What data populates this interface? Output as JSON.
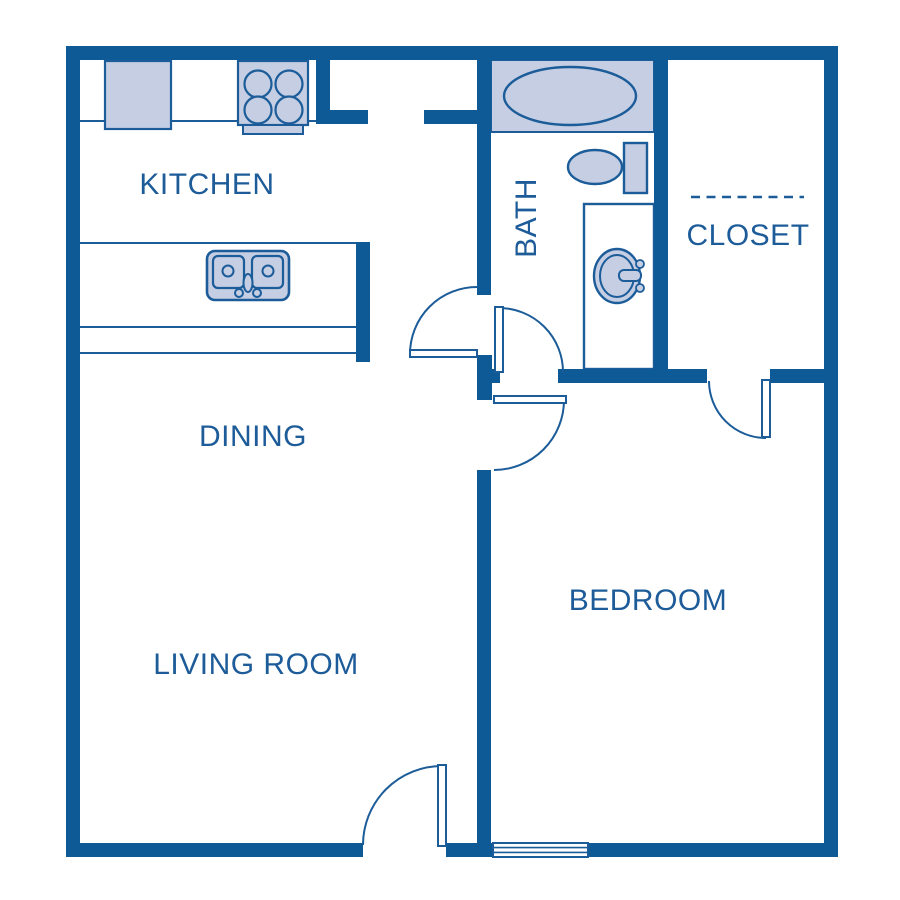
{
  "colors": {
    "wall": "#0E5A97",
    "line": "#1B5C99",
    "fill": "#C5CEE3",
    "white": "#FFFFFF",
    "text": "#1D5C99"
  },
  "rooms": [
    {
      "id": "kitchen",
      "label": "KITCHEN",
      "x": 207,
      "y": 185,
      "rotate": 0
    },
    {
      "id": "dining",
      "label": "DINING",
      "x": 253,
      "y": 437,
      "rotate": 0
    },
    {
      "id": "living-room",
      "label": "LIVING ROOM",
      "x": 256,
      "y": 665,
      "rotate": 0
    },
    {
      "id": "bedroom",
      "label": "BEDROOM",
      "x": 648,
      "y": 601,
      "rotate": 0
    },
    {
      "id": "bath",
      "label": "BATH",
      "x": 527,
      "y": 218,
      "rotate": -90
    },
    {
      "id": "closet",
      "label": "CLOSET",
      "x": 748,
      "y": 236,
      "rotate": 0
    }
  ],
  "plan": {
    "width": 900,
    "height": 900,
    "layers": [
      {
        "name": "counters",
        "items": [
          {
            "t": "line",
            "n": "kitchen-counter-edge",
            "x1": 80,
            "y1": 121,
            "x2": 316,
            "y2": 121,
            "s": "line",
            "sw": 2
          },
          {
            "t": "line",
            "n": "island-counter-edge-top",
            "x1": 80,
            "y1": 243,
            "x2": 356,
            "y2": 243,
            "s": "line",
            "sw": 2
          },
          {
            "t": "line",
            "n": "island-counter-edge-mid",
            "x1": 80,
            "y1": 327,
            "x2": 356,
            "y2": 327,
            "s": "line",
            "sw": 2
          },
          {
            "t": "line",
            "n": "island-counter-edge-bottom",
            "x1": 80,
            "y1": 353,
            "x2": 356,
            "y2": 353,
            "s": "line",
            "sw": 2
          }
        ]
      },
      {
        "name": "fixtures",
        "items": [
          {
            "t": "rect",
            "n": "refrigerator",
            "x": 105,
            "y": 61,
            "w": 66,
            "h": 68,
            "f": "fill",
            "s": "line",
            "sw": 2.2
          },
          {
            "t": "rect",
            "n": "stove",
            "x": 238,
            "y": 61,
            "w": 70,
            "h": 64,
            "f": "fill",
            "s": "line",
            "sw": 2.2
          },
          {
            "t": "rect",
            "n": "stove-tray",
            "x": 243,
            "y": 125,
            "w": 60,
            "h": 9,
            "f": "fill",
            "s": "line",
            "sw": 2
          },
          {
            "t": "circle",
            "n": "stove-burner",
            "cx": 258,
            "cy": 84,
            "r": 13.5,
            "f": "fill",
            "s": "line",
            "sw": 2.2
          },
          {
            "t": "circle",
            "n": "stove-burner",
            "cx": 289,
            "cy": 84,
            "r": 13.5,
            "f": "fill",
            "s": "line",
            "sw": 2.2
          },
          {
            "t": "circle",
            "n": "stove-burner",
            "cx": 258,
            "cy": 110,
            "r": 13.5,
            "f": "fill",
            "s": "line",
            "sw": 2.2
          },
          {
            "t": "circle",
            "n": "stove-burner",
            "cx": 289,
            "cy": 110,
            "r": 13.5,
            "f": "fill",
            "s": "line",
            "sw": 2.2
          },
          {
            "t": "rect",
            "n": "kitchen-sink",
            "x": 207,
            "y": 251,
            "w": 82,
            "h": 49,
            "rx": 8,
            "f": "fill",
            "s": "line",
            "sw": 2.6
          },
          {
            "t": "rect",
            "n": "kitchen-sink-bowl-left",
            "x": 213,
            "y": 256,
            "w": 31,
            "h": 32,
            "rx": 5,
            "f": "fill",
            "s": "line",
            "sw": 2.2
          },
          {
            "t": "rect",
            "n": "kitchen-sink-bowl-right",
            "x": 252,
            "y": 256,
            "w": 31,
            "h": 32,
            "rx": 5,
            "f": "fill",
            "s": "line",
            "sw": 2.2
          },
          {
            "t": "circle",
            "n": "kitchen-sink-drain",
            "cx": 228,
            "cy": 271,
            "r": 5.5,
            "f": "fill",
            "s": "line",
            "sw": 2
          },
          {
            "t": "circle",
            "n": "kitchen-sink-drain",
            "cx": 268,
            "cy": 271,
            "r": 5.5,
            "f": "fill",
            "s": "line",
            "sw": 2
          },
          {
            "t": "ellipse",
            "n": "kitchen-faucet",
            "cx": 248,
            "cy": 283,
            "rx": 4.5,
            "ry": 9,
            "f": "fill",
            "s": "line",
            "sw": 2
          },
          {
            "t": "circle",
            "n": "kitchen-faucet-knob",
            "cx": 239,
            "cy": 293,
            "r": 4,
            "f": "fill",
            "s": "line",
            "sw": 2
          },
          {
            "t": "circle",
            "n": "kitchen-faucet-knob",
            "cx": 257,
            "cy": 293,
            "r": 4,
            "f": "fill",
            "s": "line",
            "sw": 2
          },
          {
            "t": "rect",
            "n": "bathtub-deck",
            "x": 491,
            "y": 60,
            "w": 163,
            "h": 72,
            "f": "fill",
            "s": "line",
            "sw": 2
          },
          {
            "t": "ellipse",
            "n": "bathtub",
            "cx": 570,
            "cy": 96,
            "rx": 66,
            "ry": 29,
            "f": "fill",
            "s": "line",
            "sw": 2.4
          },
          {
            "t": "rect",
            "n": "toilet-tank",
            "x": 624,
            "y": 143,
            "w": 23,
            "h": 50,
            "f": "fill",
            "s": "line",
            "sw": 2.4
          },
          {
            "t": "ellipse",
            "n": "toilet-bowl",
            "cx": 595,
            "cy": 167,
            "rx": 27,
            "ry": 17,
            "f": "fill",
            "s": "line",
            "sw": 2.4
          },
          {
            "t": "rect",
            "n": "vanity",
            "x": 584,
            "y": 204,
            "w": 70,
            "h": 165,
            "f": "white",
            "s": "line",
            "sw": 2.4
          },
          {
            "t": "ellipse",
            "n": "vanity-sink-outer",
            "cx": 617,
            "cy": 276,
            "rx": 23,
            "ry": 27,
            "f": "fill",
            "s": "line",
            "sw": 2.4
          },
          {
            "t": "ellipse",
            "n": "vanity-sink-inner",
            "cx": 617,
            "cy": 276,
            "rx": 17,
            "ry": 21,
            "f": "fill",
            "s": "line",
            "sw": 2
          },
          {
            "t": "rect",
            "n": "vanity-faucet",
            "x": 619,
            "y": 270,
            "w": 22,
            "h": 11,
            "rx": 5,
            "f": "fill",
            "s": "line",
            "sw": 2
          },
          {
            "t": "circle",
            "n": "vanity-faucet-knob",
            "cx": 640,
            "cy": 264,
            "r": 4,
            "f": "fill",
            "s": "line",
            "sw": 1.8
          },
          {
            "t": "circle",
            "n": "vanity-faucet-knob",
            "cx": 640,
            "cy": 288,
            "r": 4,
            "f": "fill",
            "s": "line",
            "sw": 1.8
          }
        ]
      },
      {
        "name": "walls",
        "items": [
          {
            "t": "rect",
            "n": "wall-top",
            "x": 66,
            "y": 46,
            "w": 772,
            "h": 14,
            "f": "wall"
          },
          {
            "t": "rect",
            "n": "wall-left",
            "x": 66,
            "y": 46,
            "w": 14,
            "h": 811,
            "f": "wall"
          },
          {
            "t": "rect",
            "n": "wall-right",
            "x": 824,
            "y": 46,
            "w": 14,
            "h": 811,
            "f": "wall"
          },
          {
            "t": "rect",
            "n": "wall-bottom-left",
            "x": 66,
            "y": 843,
            "w": 297,
            "h": 14,
            "f": "wall"
          },
          {
            "t": "rect",
            "n": "wall-bottom-mid",
            "x": 446,
            "y": 843,
            "w": 47,
            "h": 14,
            "f": "wall"
          },
          {
            "t": "rect",
            "n": "wall-bottom-right",
            "x": 588,
            "y": 843,
            "w": 250,
            "h": 14,
            "f": "wall"
          },
          {
            "t": "rect",
            "n": "wall-kitchen-vert",
            "x": 316,
            "y": 60,
            "w": 14,
            "h": 64,
            "f": "wall"
          },
          {
            "t": "rect",
            "n": "wall-kitchen-stub",
            "x": 330,
            "y": 110,
            "w": 38,
            "h": 14,
            "f": "wall"
          },
          {
            "t": "rect",
            "n": "wall-nook-stub",
            "x": 424,
            "y": 110,
            "w": 53,
            "h": 14,
            "f": "wall"
          },
          {
            "t": "rect",
            "n": "wall-bath-left",
            "x": 477,
            "y": 60,
            "w": 14,
            "h": 235,
            "f": "wall"
          },
          {
            "t": "rect",
            "n": "wall-hall-block",
            "x": 477,
            "y": 355,
            "w": 15,
            "h": 45,
            "f": "wall"
          },
          {
            "t": "rect",
            "n": "wall-hall-nub",
            "x": 491,
            "y": 369,
            "w": 9,
            "h": 14,
            "f": "wall"
          },
          {
            "t": "rect",
            "n": "wall-bedroom-divider",
            "x": 477,
            "y": 470,
            "w": 14,
            "h": 373,
            "f": "wall"
          },
          {
            "t": "rect",
            "n": "wall-bath-bottom",
            "x": 558,
            "y": 369,
            "w": 149,
            "h": 14,
            "f": "wall"
          },
          {
            "t": "rect",
            "n": "wall-closet-bottom",
            "x": 770,
            "y": 369,
            "w": 54,
            "h": 14,
            "f": "wall"
          },
          {
            "t": "rect",
            "n": "wall-bath-right",
            "x": 654,
            "y": 60,
            "w": 14,
            "h": 323,
            "f": "wall"
          },
          {
            "t": "rect",
            "n": "wall-island-end",
            "x": 356,
            "y": 242,
            "w": 14,
            "h": 120,
            "f": "wall"
          }
        ]
      },
      {
        "name": "openings",
        "items": [
          {
            "t": "rect",
            "n": "bedroom-window",
            "x": 493,
            "y": 843,
            "w": 95,
            "h": 14,
            "f": "white",
            "s": "line",
            "sw": 2
          },
          {
            "t": "line",
            "n": "bedroom-window-pane",
            "x1": 494,
            "y1": 847.6,
            "x2": 587,
            "y2": 847.6,
            "s": "line",
            "sw": 1.6
          },
          {
            "t": "line",
            "n": "bedroom-window-pane",
            "x1": 494,
            "y1": 852.4,
            "x2": 587,
            "y2": 852.4,
            "s": "line",
            "sw": 1.6
          },
          {
            "t": "line",
            "n": "closet-rod",
            "x1": 691,
            "y1": 197,
            "x2": 804,
            "y2": 197,
            "s": "line",
            "sw": 2.4,
            "dash": "9 6.5"
          }
        ]
      },
      {
        "name": "doors",
        "items": [
          {
            "t": "path",
            "n": "bath-door-swing",
            "d": "M 410 354 A 67 67 0 0 1 477 287",
            "s": "line",
            "sw": 2
          },
          {
            "t": "rect",
            "n": "bath-door-leaf",
            "x": 410,
            "y": 350,
            "w": 67,
            "h": 7,
            "f": "white",
            "s": "line",
            "sw": 2
          },
          {
            "t": "path",
            "n": "bath-bedroom-door-swing",
            "d": "M 499 308 A 64 64 0 0 1 563 372",
            "s": "line",
            "sw": 2
          },
          {
            "t": "rect",
            "n": "bath-bedroom-door-leaf",
            "x": 495,
            "y": 307,
            "w": 8,
            "h": 65,
            "f": "white",
            "s": "line",
            "sw": 2
          },
          {
            "t": "path",
            "n": "bedroom-door-swing",
            "d": "M 564 400 A 70 70 0 0 1 494 470",
            "s": "line",
            "sw": 2
          },
          {
            "t": "rect",
            "n": "bedroom-door-leaf",
            "x": 494,
            "y": 396,
            "w": 72,
            "h": 7,
            "f": "white",
            "s": "line",
            "sw": 2
          },
          {
            "t": "path",
            "n": "closet-door-swing",
            "d": "M 709 381 A 57 57 0 0 0 766 438",
            "s": "line",
            "sw": 2
          },
          {
            "t": "rect",
            "n": "closet-door-leaf",
            "x": 762,
            "y": 380,
            "w": 8,
            "h": 57,
            "f": "white",
            "s": "line",
            "sw": 2
          },
          {
            "t": "path",
            "n": "entry-door-swing",
            "d": "M 442 766 A 79 79 0 0 0 363 845",
            "s": "line",
            "sw": 2
          },
          {
            "t": "rect",
            "n": "entry-door-leaf",
            "x": 438,
            "y": 765,
            "w": 8,
            "h": 81,
            "f": "white",
            "s": "line",
            "sw": 2
          }
        ]
      }
    ]
  }
}
